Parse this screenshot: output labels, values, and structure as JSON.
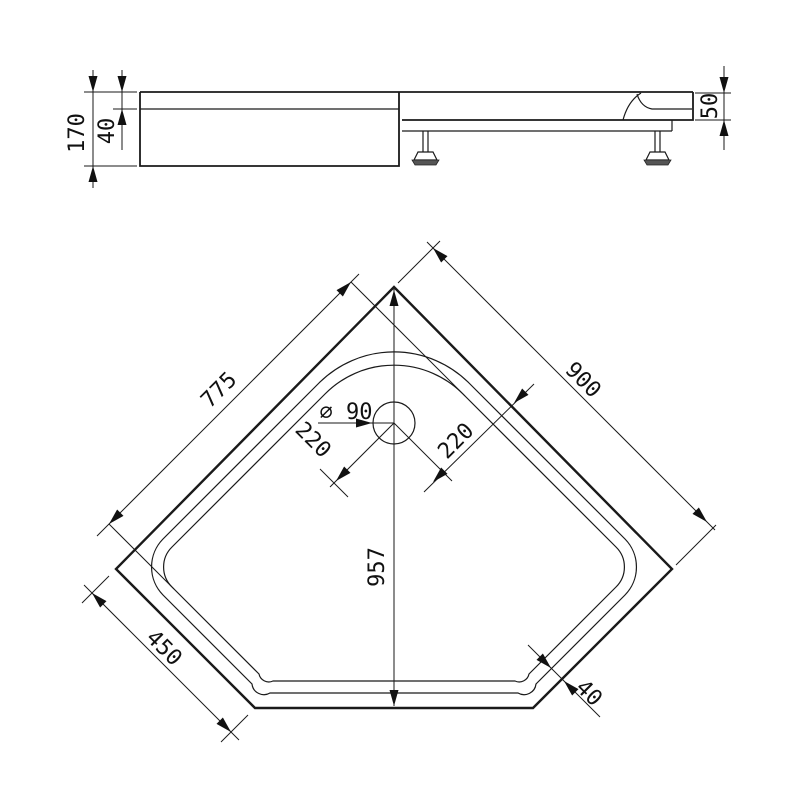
{
  "drawing": {
    "type": "technical-dimension-drawing",
    "subject": "pentagonal corner shower tray",
    "line_color": "#1a1a1a",
    "background": "#ffffff",
    "side_view": {
      "labels": {
        "total_height": "170",
        "rim_height": "40",
        "tray_height": "50"
      }
    },
    "plan_view": {
      "labels": {
        "edge_left": "775",
        "edge_right": "900",
        "diagonal_depth": "957",
        "front_corner_edge": "450",
        "drain_diameter": "⌀ 90",
        "drain_offset_left": "220",
        "drain_offset_right": "220",
        "rim_width": "40"
      }
    }
  }
}
